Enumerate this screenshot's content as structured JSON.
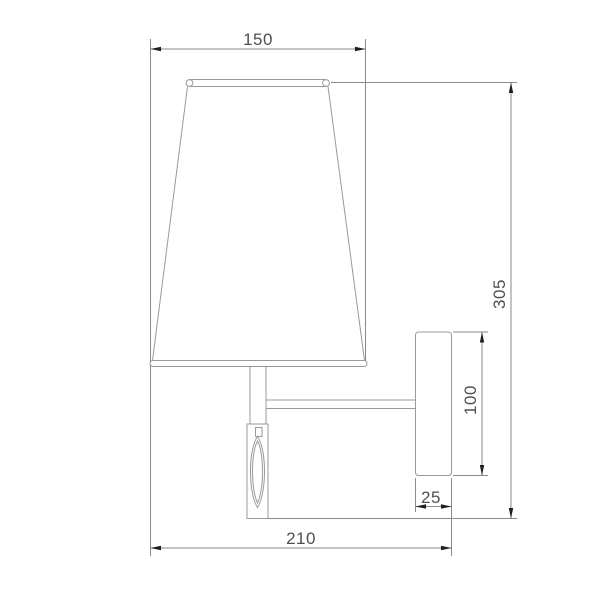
{
  "drawing": {
    "dimensions": {
      "shade_diameter": "150",
      "overall_height": "305",
      "backplate_height": "100",
      "backplate_depth": "25",
      "overall_projection": "210"
    },
    "colors": {
      "background": "#ffffff",
      "line": "#9a9a9a",
      "dimension": "#8a8a8a",
      "arrow": "#1f1f1f",
      "text": "#4f4f4f"
    }
  }
}
